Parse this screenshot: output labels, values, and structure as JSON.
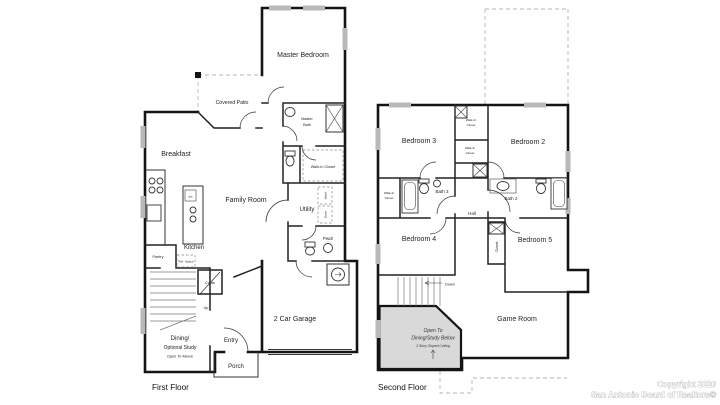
{
  "meta": {
    "document_type": "residential floor plan drawing"
  },
  "colors": {
    "background": "#ffffff",
    "wall": "#141414",
    "interior_wall": "#222222",
    "window": "#b9b9b9",
    "dashed_outline": "#b5b5b5",
    "open_area": "#d9d9d9",
    "stair_lines": "#777777",
    "label_text": "#1f1f1f",
    "copyright_fill": "#ffffff",
    "copyright_outline": "#979797"
  },
  "first_floor": {
    "title": "First Floor",
    "labels": {
      "master_bedroom": "Master Bedroom",
      "covered_patio": "Covered Patio",
      "breakfast": "Breakfast",
      "family_room": "Family Room",
      "master_bath_line1": "Master",
      "master_bath_line2": "Bath",
      "walk_in_closet": "Walk-In Closet",
      "utility": "Utility",
      "washer": "Wash",
      "dryer": "Dryer",
      "pwdr": "Pwdr",
      "kitchen": "Kitchen",
      "dw": "dw",
      "ref_space": "Ref. Space",
      "pantry": "Pantry",
      "coats": "Coats",
      "up": "Up",
      "dining_line1": "Dining/",
      "dining_line2": "Optional Study",
      "dining_line3": "Open To Above",
      "entry": "Entry",
      "porch": "Porch",
      "garage": "2 Car Garage"
    }
  },
  "second_floor": {
    "title": "Second Floor",
    "labels": {
      "bedroom2": "Bedroom 2",
      "bedroom3": "Bedroom 3",
      "bedroom4": "Bedroom 4",
      "bedroom5": "Bedroom 5",
      "wic_top_a_line1": "Walk-In",
      "wic_top_a_line2": "Closet",
      "wic_top_b_line1": "Walk-In",
      "wic_top_b_line2": "Closet",
      "wic_left_line1": "Walk-In",
      "wic_left_line2": "Closet",
      "bath2": "Bath 2",
      "bath3": "Bath 3",
      "hall": "Hall",
      "closet": "Closet",
      "down": "Down",
      "game_room": "Game Room",
      "open_line1": "Open To",
      "open_line2": "Dining/Study Below",
      "open_line3": "2 Story Sloped Ceiling"
    }
  },
  "footer": {
    "copyright_line1": "Copyright 2026",
    "copyright_line2": "San Antonio Board of Realtors®"
  }
}
